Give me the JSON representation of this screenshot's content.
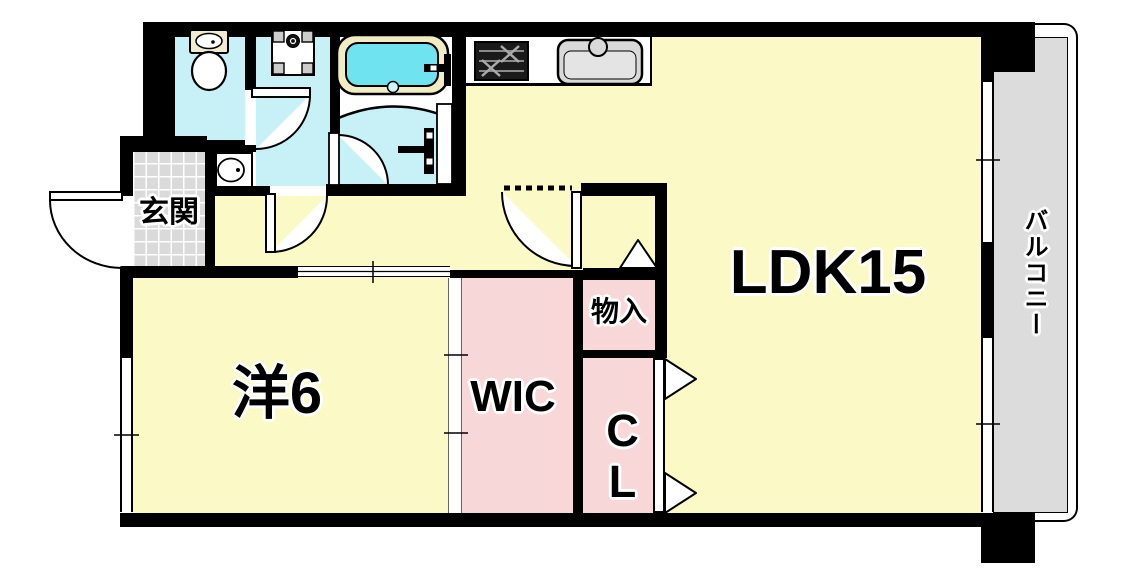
{
  "page": {
    "type": "apartment-floorplan",
    "background": "#ffffff"
  },
  "rooms": {
    "ldk": {
      "label": "LDK15"
    },
    "western": {
      "label": "洋6"
    },
    "wic": {
      "label": "WIC"
    },
    "closet": {
      "label": "CL"
    },
    "storage": {
      "label": "物入"
    },
    "entrance": {
      "label": "玄関"
    },
    "balcony": {
      "label": "バルコニー"
    }
  },
  "colors": {
    "wall": "#000000",
    "room_yellow": "#fbf9c5",
    "closet_pink": "#f8d7d8",
    "wet_area_cyan": "#c7f0f7",
    "bathtub_water": "#6fe3f0",
    "bathtub_rim": "#f2ecc5",
    "entrance_tile_gray": "#dadada",
    "balcony_gray": "#dcdcdc",
    "fixture_gray": "#d9d9d9"
  },
  "fixtures": {
    "toilet": "toilet",
    "washer_pan": "washing-machine-pan",
    "bathtub": "bathtub",
    "hand_basin": "hand-washbasin",
    "vanity_faucet": "vanity-faucet",
    "gas_stove": "gas-stove",
    "kitchen_sink": "kitchen-sink"
  }
}
